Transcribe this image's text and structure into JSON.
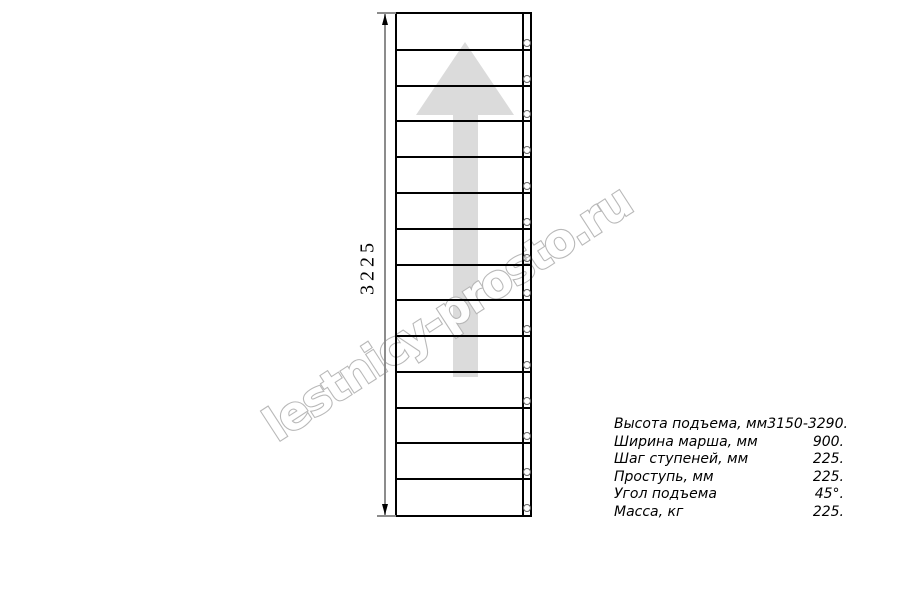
{
  "drawing": {
    "type": "straight-stair-plan-view",
    "dimension_label": "3225",
    "tread_count": 14,
    "arrow_direction": "up"
  },
  "specs": [
    {
      "label": "Высота подъема, мм",
      "value": "3150-3290."
    },
    {
      "label": "Ширина марша, мм",
      "value": "900."
    },
    {
      "label": "Шаг ступеней, мм",
      "value": "225."
    },
    {
      "label": "Проступь, мм",
      "value": "225."
    },
    {
      "label": "Угол подъема",
      "value": "45°."
    },
    {
      "label": "Масса, кг",
      "value": "225."
    }
  ],
  "watermark": {
    "text": "lestnicy-prosto.ru"
  },
  "colors": {
    "line": "#000000",
    "dimension_line": "#8c8c8c",
    "arrow_fill": "#dbdbdb",
    "watermark_stroke": "#b5b5b5",
    "text": "#000000",
    "background": "#ffffff"
  }
}
